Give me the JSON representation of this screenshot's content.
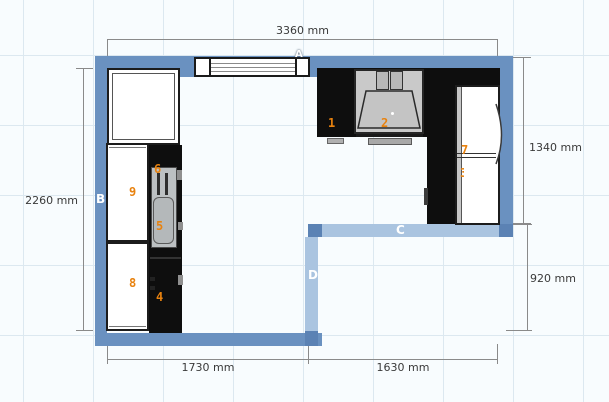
{
  "canvas": {
    "width": 609,
    "height": 402,
    "background": "#f8fcfe",
    "grid_color": "#dce8f0",
    "grid_size_px": 70
  },
  "colors": {
    "wall": "#6a91c0",
    "wall_selected": "#aac4e0",
    "wall_selected_end": "#5b82b4",
    "furniture_dark": "#0e0e0e",
    "hood_gray": "#c9c9c9",
    "sink_gray": "#bcc0c2",
    "item_label_orange": "#e8820f",
    "dimension_text": "#3a3a3a",
    "dimension_line": "#8a8a8a"
  },
  "walls": {
    "labels": [
      {
        "id": "A"
      },
      {
        "id": "B"
      },
      {
        "id": "C"
      },
      {
        "id": "D"
      }
    ]
  },
  "dimensions": [
    {
      "side": "top",
      "text": "3360 mm"
    },
    {
      "side": "left",
      "text": "2260 mm"
    },
    {
      "side": "right-upper",
      "text": "1340 mm"
    },
    {
      "side": "right-lower",
      "text": "920 mm"
    },
    {
      "side": "bottom-left",
      "text": "1730 mm"
    },
    {
      "side": "bottom-right",
      "text": "1630 mm"
    }
  ],
  "items": [
    {
      "number": "1",
      "name": "worktop-left-section"
    },
    {
      "number": "2",
      "name": "cooktop-under-hood"
    },
    {
      "number": "3",
      "name": "worktop-right-section"
    },
    {
      "number": "4",
      "name": "base-counter"
    },
    {
      "number": "5",
      "name": "sink-basin"
    },
    {
      "number": "6",
      "name": "sink-drainer"
    },
    {
      "number": "7",
      "name": "refrigerator"
    },
    {
      "number": "8",
      "name": "cabinet-lower"
    },
    {
      "number": "9",
      "name": "cabinet-upper"
    }
  ]
}
